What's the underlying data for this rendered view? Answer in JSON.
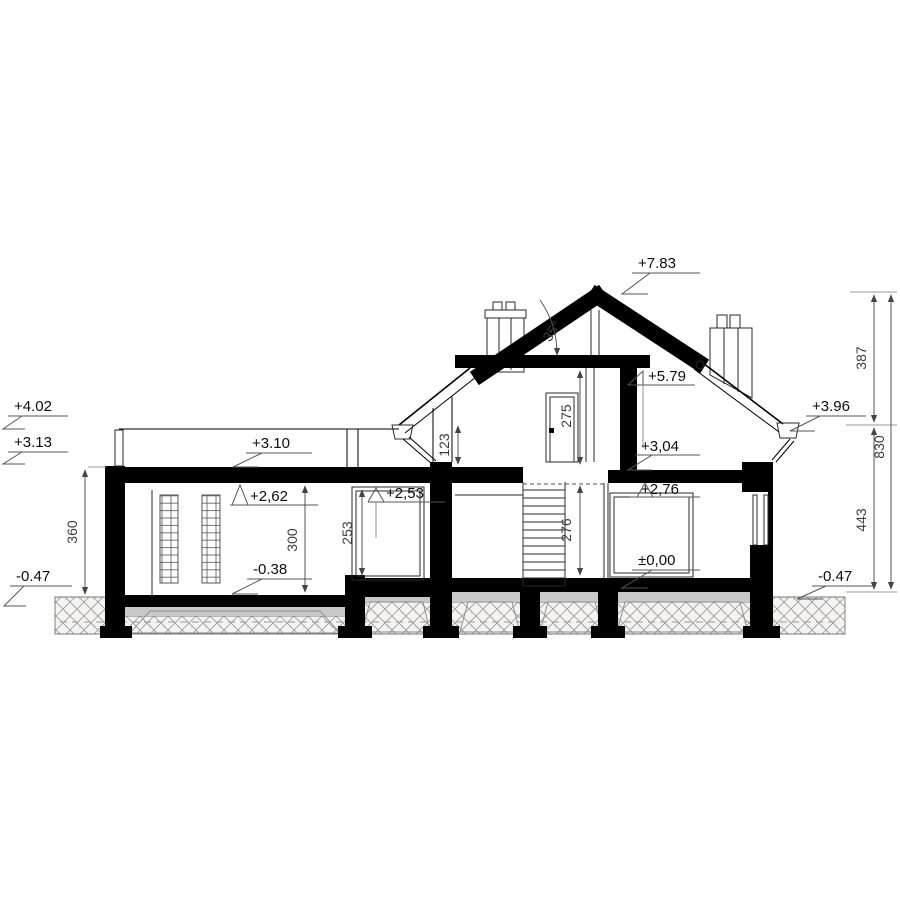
{
  "drawing": {
    "type": "house-cross-section",
    "angle": {
      "roof_pitch": "35°"
    },
    "levels": {
      "p783": "+7.83",
      "p579": "+5.79",
      "p402": "+4.02",
      "p313": "+3.13",
      "p396": "+3.96",
      "p310": "+3.10",
      "p262": "+2,62",
      "p253": "+2,53",
      "p304": "+3,04",
      "p276": "+2,76",
      "p000": "±0,00",
      "m038": "-0.38",
      "m047_left": "-0.47",
      "m047_right": "-0.47"
    },
    "dimensions": {
      "d360": "360",
      "d300": "300",
      "d253": "253",
      "d123": "123",
      "d275": "275",
      "d276": "276",
      "d387": "387",
      "d830": "830",
      "d443": "443"
    },
    "colors": {
      "ink": "#000000",
      "ground_hatch": "#9a9a9a",
      "underlay_gray": "#c9c9c9",
      "background": "#ffffff"
    }
  }
}
